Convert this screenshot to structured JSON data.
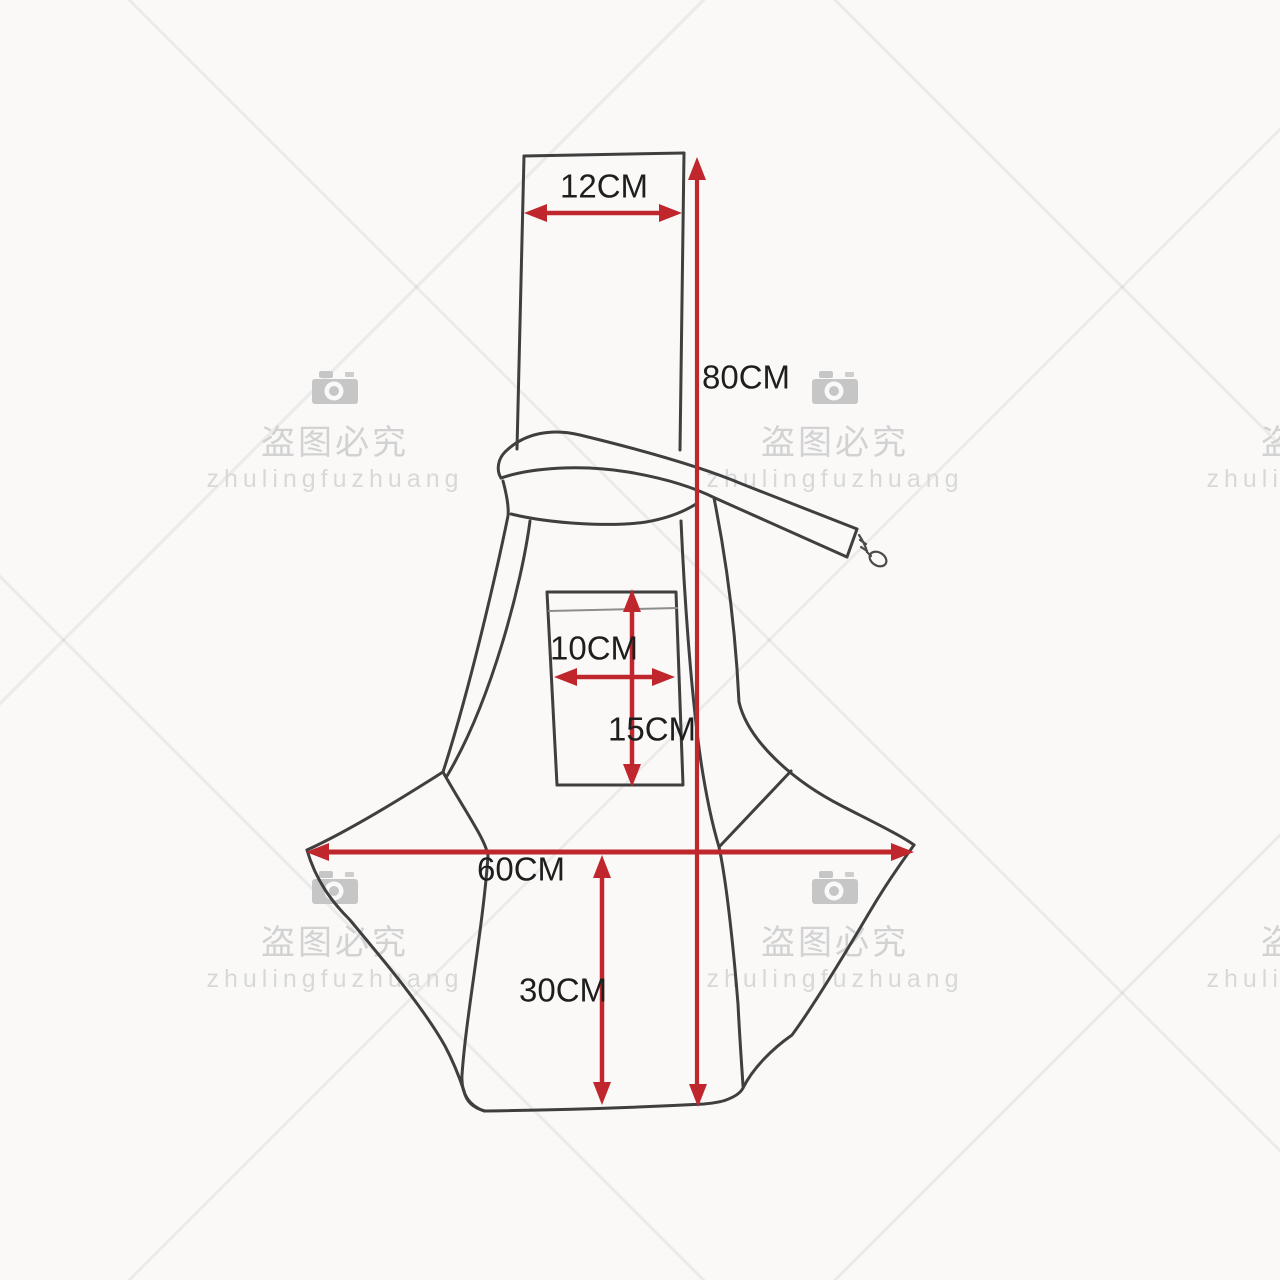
{
  "dimensions": {
    "strap_width": "12CM",
    "total_height": "80CM",
    "pocket_width": "10CM",
    "pocket_height": "15CM",
    "bag_width": "60CM",
    "bottom_height": "30CM"
  },
  "watermark": {
    "camera_icon": "camera-icon",
    "chinese_text": "盗图必究",
    "brand_text": "zhulingfuzhuang"
  },
  "colors": {
    "dimension_red": "#bf272d",
    "outline": "#3f3f3f",
    "watermark_text": "#d2d2d2",
    "background": "#faf9f8"
  }
}
